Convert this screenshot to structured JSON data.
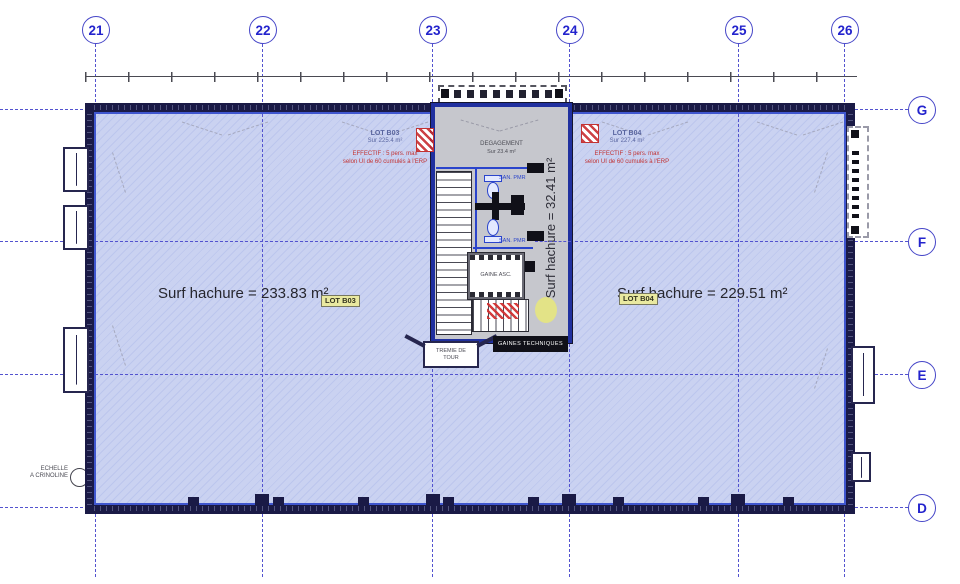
{
  "drawing": {
    "grid": {
      "columns": [
        "21",
        "22",
        "23",
        "24",
        "25",
        "26"
      ],
      "rows": [
        "G",
        "F",
        "E",
        "D"
      ]
    },
    "zones": {
      "left": {
        "surface": "Surf hachure = 233.83 m²",
        "badge": "LOT B03"
      },
      "right": {
        "surface": "Surf hachure = 229.51 m²",
        "badge": "LOT B04"
      },
      "core": {
        "surface": "Surf hachure = 32.41 m²"
      }
    },
    "core": {
      "degagement_title": "DEGAGEMENT",
      "degagement_sub": "Sur 23.4 m²",
      "elevator": "GAINE ASC.",
      "san1": "SAN. PMR",
      "san2": "SAN. PMR",
      "tremie_line1": "TREMIE DE",
      "tremie_line2": "TOUR",
      "cartouche": "GAINES TECHNIQUES"
    },
    "notes": {
      "b03_title": "LOT B03",
      "b03_sub": "Sur 225.4 m²",
      "b03_note1": "EFFECTIF : 5 pers. max",
      "b03_note2": "selon UI de 60 cumulés à l'ERP",
      "b04_title": "LOT B04",
      "b04_sub": "Sur 227.4 m²",
      "b04_note1": "EFFECTIF : 5 pers. max",
      "b04_note2": "selon UI de 60 cumulés à l'ERP",
      "crinoline_line1": "ECHELLE",
      "crinoline_line2": "A CRINOLINE"
    },
    "colors": {
      "floor_fill": "#cad2f1",
      "core_fill": "#c6c7cd",
      "wall": "#1a1a46",
      "grid_blue": "#5353cf",
      "fixture_blue": "#2a44cc",
      "annotation_red": "#c23333",
      "badge_yellow": "#e9e9a0"
    }
  }
}
